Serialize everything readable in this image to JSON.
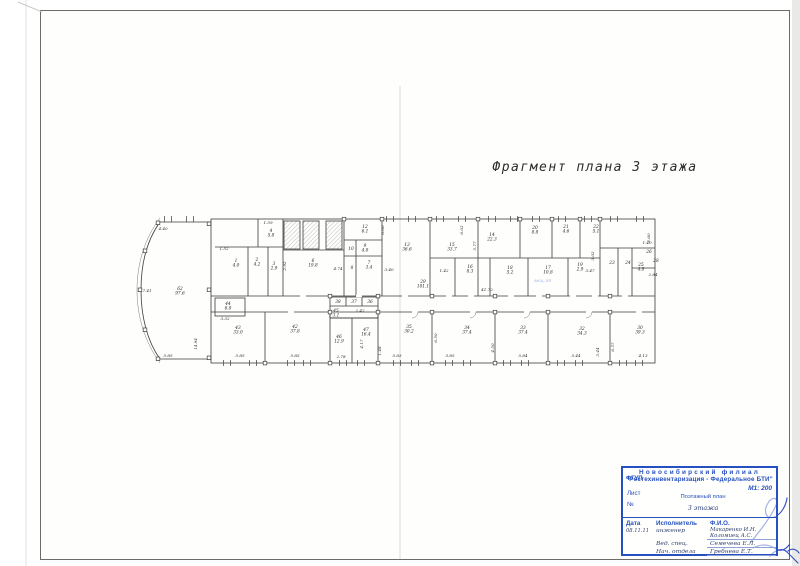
{
  "plan_title": "Фрагмент плана 3 этажа",
  "corridor_stamp": "АКЦ-ЭП",
  "title_block": {
    "org_prefix": "ФГУП",
    "org_line1": "Новосибирский филиал",
    "org_line2": "\"Ростехинвентаризация - Федеральное БТИ\"",
    "sheet_label": "Лист",
    "number_label": "№",
    "scale": "М1: 200",
    "doc_type": "Поэтажный план",
    "doc_floor": "3 этажа",
    "col_date": "Дата",
    "col_role": "Исполнитель",
    "col_name": "Ф.И.О.",
    "date_value": "08.11.11",
    "rows": [
      {
        "role": "инженер",
        "name1": "Макаренко И.Н.",
        "name2": "Коломиец А.С."
      },
      {
        "role": "Вед. спец.",
        "name1": "Семечева Е.Л.",
        "name2": ""
      },
      {
        "role": "Нач. отдела",
        "name1": "Гребнева Е.Т.",
        "name2": ""
      }
    ]
  },
  "plan": {
    "rooms": [
      {
        "n": "62",
        "a": "97.6",
        "x": 180,
        "y": 290
      },
      {
        "n": "1",
        "a": "4.0",
        "x": 236,
        "y": 262
      },
      {
        "n": "2",
        "a": "4.2",
        "x": 257,
        "y": 261
      },
      {
        "n": "3",
        "a": "2.9",
        "x": 274,
        "y": 265
      },
      {
        "n": "4",
        "a": "5.8",
        "x": 271,
        "y": 232
      },
      {
        "n": "6",
        "a": "19.8",
        "x": 313,
        "y": 262
      },
      {
        "n": "12",
        "a": "6.1",
        "x": 365,
        "y": 228
      },
      {
        "n": "9",
        "a": "4.0",
        "x": 365,
        "y": 247
      },
      {
        "n": "10",
        "a": "",
        "x": 351,
        "y": 250
      },
      {
        "n": "8",
        "a": "",
        "x": 352,
        "y": 269
      },
      {
        "n": "7",
        "a": "3.4",
        "x": 369,
        "y": 264
      },
      {
        "n": "13",
        "a": "36.6",
        "x": 407,
        "y": 246
      },
      {
        "n": "15",
        "a": "33.7",
        "x": 452,
        "y": 246
      },
      {
        "n": "14",
        "a": "22.3",
        "x": 492,
        "y": 236
      },
      {
        "n": "20",
        "a": "8.8",
        "x": 535,
        "y": 229
      },
      {
        "n": "21",
        "a": "4.6",
        "x": 566,
        "y": 228
      },
      {
        "n": "22",
        "a": "5.1",
        "x": 596,
        "y": 228
      },
      {
        "n": "16",
        "a": "8.3",
        "x": 470,
        "y": 268
      },
      {
        "n": "18",
        "a": "5.2",
        "x": 510,
        "y": 269
      },
      {
        "n": "17",
        "a": "10.8",
        "x": 548,
        "y": 269
      },
      {
        "n": "19",
        "a": "2.9",
        "x": 580,
        "y": 266
      },
      {
        "n": "23",
        "a": "",
        "x": 612,
        "y": 264
      },
      {
        "n": "24",
        "a": "",
        "x": 628,
        "y": 264
      },
      {
        "n": "26",
        "a": "",
        "x": 649,
        "y": 253
      },
      {
        "n": "25",
        "a": "4.8",
        "x": 641,
        "y": 266
      },
      {
        "n": "28",
        "a": "",
        "x": 656,
        "y": 262
      },
      {
        "n": "29",
        "a": "101.1",
        "x": 423,
        "y": 283
      },
      {
        "n": "38",
        "a": "",
        "x": 338,
        "y": 303
      },
      {
        "n": "37",
        "a": "",
        "x": 354,
        "y": 303
      },
      {
        "n": "36",
        "a": "",
        "x": 370,
        "y": 303
      },
      {
        "n": "44",
        "a": "6.0",
        "x": 228,
        "y": 305
      },
      {
        "n": "45",
        "a": "3.1",
        "x": 336,
        "y": 312
      },
      {
        "n": "43",
        "a": "33.0",
        "x": 238,
        "y": 329
      },
      {
        "n": "42",
        "a": "37.8",
        "x": 295,
        "y": 328
      },
      {
        "n": "46",
        "a": "12.9",
        "x": 339,
        "y": 338
      },
      {
        "n": "47",
        "a": "16.4",
        "x": 366,
        "y": 331
      },
      {
        "n": "35",
        "a": "30.2",
        "x": 409,
        "y": 328
      },
      {
        "n": "34",
        "a": "37.4",
        "x": 467,
        "y": 329
      },
      {
        "n": "33",
        "a": "37.4",
        "x": 523,
        "y": 329
      },
      {
        "n": "32",
        "a": "34.3",
        "x": 582,
        "y": 330
      },
      {
        "n": "30",
        "a": "39.3",
        "x": 640,
        "y": 329
      }
    ],
    "dimensions": [
      {
        "t": "4.40",
        "x": 163,
        "y": 230
      },
      {
        "t": "1.59",
        "x": 268,
        "y": 224
      },
      {
        "t": "7.41",
        "x": 147,
        "y": 292
      },
      {
        "t": "1.52",
        "x": 224,
        "y": 250
      },
      {
        "t": "2.92",
        "x": 286,
        "y": 266,
        "v": true
      },
      {
        "t": "4.74",
        "x": 338,
        "y": 270
      },
      {
        "t": "3.40",
        "x": 389,
        "y": 271
      },
      {
        "t": "6.60",
        "x": 384,
        "y": 230,
        "v": true
      },
      {
        "t": "6.02",
        "x": 463,
        "y": 230,
        "v": true
      },
      {
        "t": "5.77",
        "x": 476,
        "y": 246,
        "v": true
      },
      {
        "t": "1.42",
        "x": 444,
        "y": 272
      },
      {
        "t": "3.47",
        "x": 590,
        "y": 272
      },
      {
        "t": "3.02",
        "x": 594,
        "y": 256,
        "v": true
      },
      {
        "t": "2.60",
        "x": 650,
        "y": 238,
        "v": true
      },
      {
        "t": "1.40",
        "x": 647,
        "y": 244
      },
      {
        "t": "2.84",
        "x": 653,
        "y": 276
      },
      {
        "t": "41.72",
        "x": 487,
        "y": 291
      },
      {
        "t": "3.32",
        "x": 225,
        "y": 320
      },
      {
        "t": "2.42",
        "x": 360,
        "y": 312
      },
      {
        "t": "14.94",
        "x": 197,
        "y": 344,
        "v": true
      },
      {
        "t": "5.85",
        "x": 168,
        "y": 357
      },
      {
        "t": "5.85",
        "x": 240,
        "y": 357
      },
      {
        "t": "5.85",
        "x": 295,
        "y": 357
      },
      {
        "t": "2.78",
        "x": 341,
        "y": 358
      },
      {
        "t": "1.48",
        "x": 381,
        "y": 351,
        "v": true
      },
      {
        "t": "5.83",
        "x": 397,
        "y": 357
      },
      {
        "t": "4.17",
        "x": 363,
        "y": 344,
        "v": true
      },
      {
        "t": "3.85",
        "x": 450,
        "y": 357
      },
      {
        "t": "6.50",
        "x": 437,
        "y": 338,
        "v": true
      },
      {
        "t": "4.50",
        "x": 494,
        "y": 348,
        "v": true
      },
      {
        "t": "5.84",
        "x": 523,
        "y": 357
      },
      {
        "t": "5.44",
        "x": 576,
        "y": 357
      },
      {
        "t": "3.44",
        "x": 599,
        "y": 352,
        "v": true
      },
      {
        "t": "6.57",
        "x": 614,
        "y": 347,
        "v": true
      },
      {
        "t": "4.13",
        "x": 643,
        "y": 357
      }
    ]
  }
}
